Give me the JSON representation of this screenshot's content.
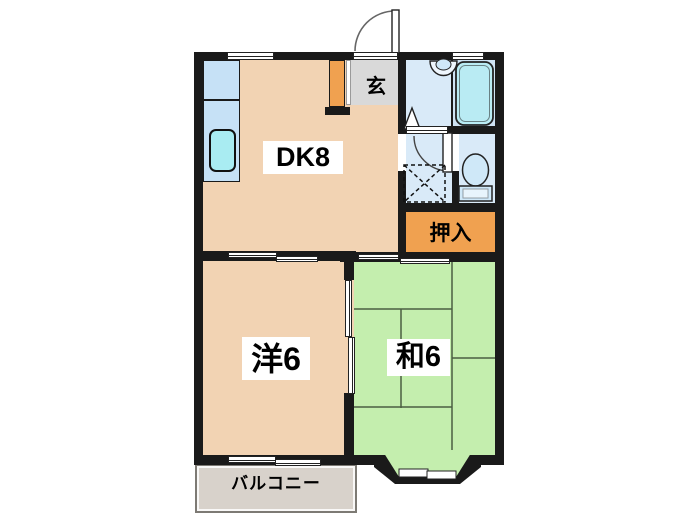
{
  "title": "2DK apartment floor plan",
  "rooms": {
    "dk": {
      "label": "DK8"
    },
    "genkan": {
      "label": "玄"
    },
    "oshiire": {
      "label": "押入"
    },
    "western": {
      "label": "洋6"
    },
    "japanese": {
      "label": "和6"
    },
    "balcony": {
      "label": "バルコニー"
    }
  },
  "colors": {
    "wall": "#1a1a1a",
    "floor_tan": "#f2d3b3",
    "tatami_green": "#c4eeae",
    "storage_orange": "#f0a150",
    "genkan_gray": "#d9d9d9",
    "washroom_blue": "#d9eaf8",
    "bath_blue": "#cfe3f4",
    "tub_cyan": "#b9ebf3",
    "counter_blue": "#c6e1f6",
    "sink_cyan": "#a9ecf2",
    "toilet_fixture": "#cfe8f8",
    "balcony_fill": "#d8d2cb",
    "balcony_border": "#7d7a74",
    "tatami_line": "#4b5e42"
  }
}
